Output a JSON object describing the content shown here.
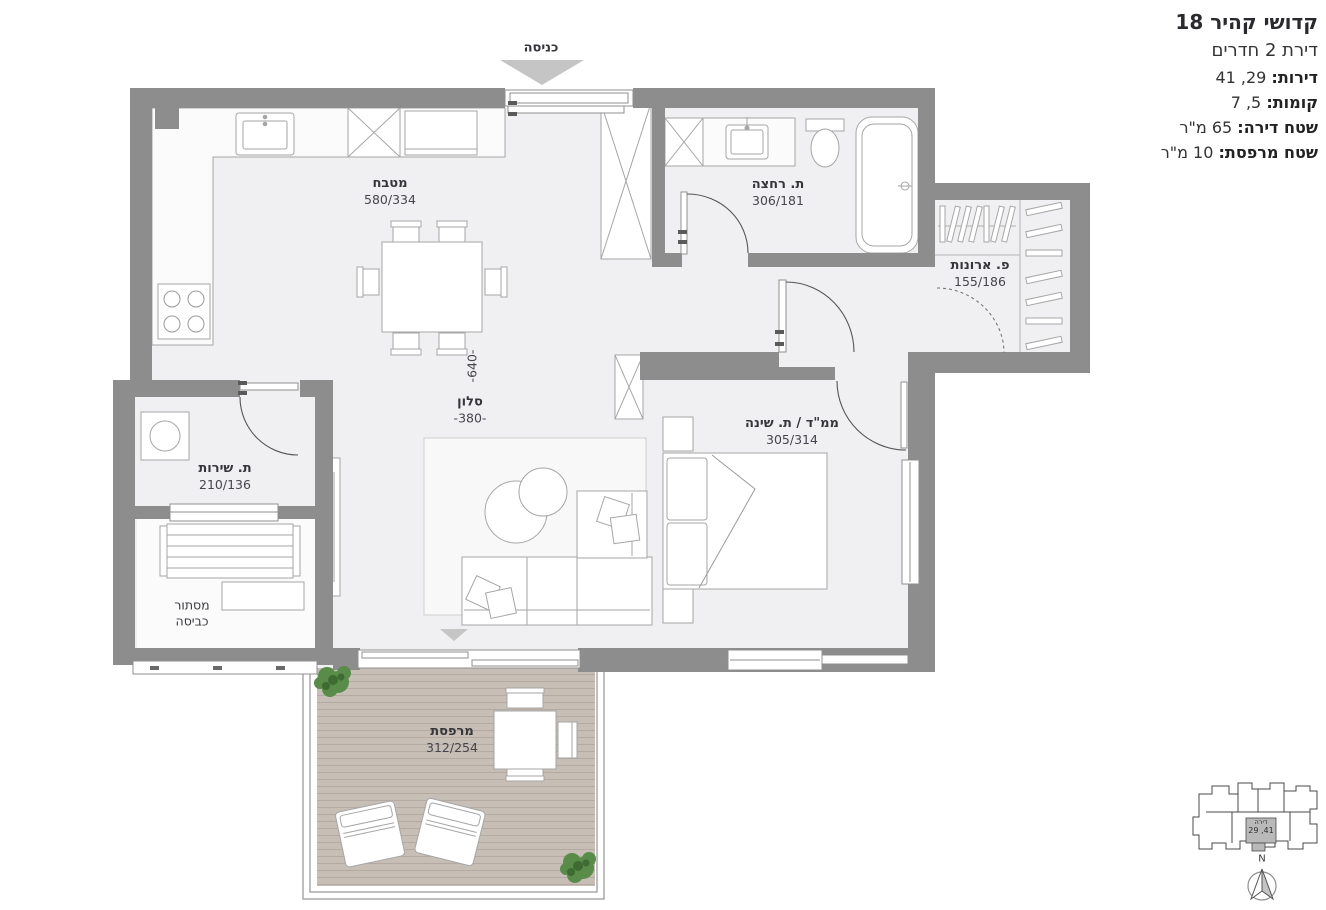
{
  "header": {
    "title": "קדושי קהיר 18",
    "subtitle": "דירת 2 חדרים",
    "fields": [
      {
        "label": "דירות:",
        "value": "29, 41"
      },
      {
        "label": "קומות:",
        "value": "5, 7"
      },
      {
        "label": "שטח דירה:",
        "value": "65 מ\"ר"
      },
      {
        "label": "שטח מרפסת:",
        "value": "10 מ\"ר"
      }
    ]
  },
  "plan": {
    "entrance_label": "כניסה",
    "rooms": {
      "kitchen": {
        "name": "מטבח",
        "dims": "580/334"
      },
      "bathroom": {
        "name": "ת. רחצה",
        "dims": "306/181"
      },
      "closets": {
        "name": "פ. ארונות",
        "dims": "155/186"
      },
      "living": {
        "name": "סלון",
        "width_dim": "-380-",
        "depth_dim": "-640-"
      },
      "bedroom": {
        "name": "ממ\"ד / ת. שינה",
        "dims": "305/314"
      },
      "service": {
        "name": "ת. שירות",
        "dims": "210/136"
      },
      "laundry": {
        "name_line1": "מסתור",
        "name_line2": "כביסה"
      },
      "balcony": {
        "name": "מרפסת",
        "dims": "312/254"
      }
    }
  },
  "key_plan": {
    "unit_label": "דירה",
    "unit_numbers": "41, 29",
    "north_letter": "N"
  },
  "colors": {
    "wall": "#8d8d8d",
    "floor": "#f0f0f2",
    "deck": "#c7beb6",
    "plant_green": "#5a8c49",
    "arrow_gray": "#c5c5c5",
    "highlight_unit": "#b9b9b9"
  }
}
